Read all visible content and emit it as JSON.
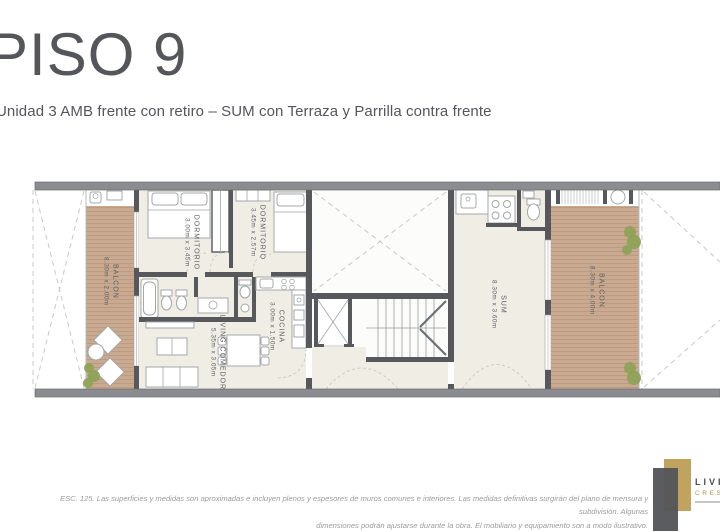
{
  "header": {
    "title": "PISO 9",
    "subtitle": "Unidad 3 AMB frente con retiro – SUM con Terraza y Parrilla contra frente"
  },
  "rooms": {
    "balcon_left": {
      "name": "BALCON",
      "dims": "8.30m x 2.00m"
    },
    "dormitorio_1": {
      "name": "DORMITORIO",
      "dims": "3.00m x 3.45m"
    },
    "dormitorio_2": {
      "name": "DORMITORIO",
      "dims": "3.45m x 2.57m"
    },
    "living": {
      "name": "LIVING COMEDOR",
      "dims": "5.35m x 3.05m"
    },
    "cocina": {
      "name": "COCINA",
      "dims": "3.00m x 1.50m"
    },
    "sum": {
      "name": "SUM",
      "dims": "8.30m x 3.60m"
    },
    "balcon_right": {
      "name": "BALCON",
      "dims": "8.30m x 4.00m"
    }
  },
  "footer": {
    "disclaimer_line1": "ESC. 125. Las superficies y medidas son aproximadas e incluyen plenos y espesores de muros comunes e interiores. Las medidas definitivas surgirán del plano de mensura y subdivisión. Algunas",
    "disclaimer_line2": "dimensiones podrán ajustarse durante la obra. El mobiliario y equipamiento son a modo ilustrativo.",
    "logo": {
      "line1": "LIVI",
      "line2": "CRES"
    }
  },
  "theme": {
    "wall": "#8a8c8f",
    "wall_dark": "#56585b",
    "wood": "#c9aa90",
    "wood_line": "#bb9c82",
    "floor": "#f0ede5",
    "dash": "#c9c9c9",
    "furniture": "#a3a7a8",
    "green": "#8fa257",
    "ink": "#54565a",
    "muted": "#9c9c9c",
    "gold": "#c0a35e",
    "logo_dark": "#56575a"
  }
}
